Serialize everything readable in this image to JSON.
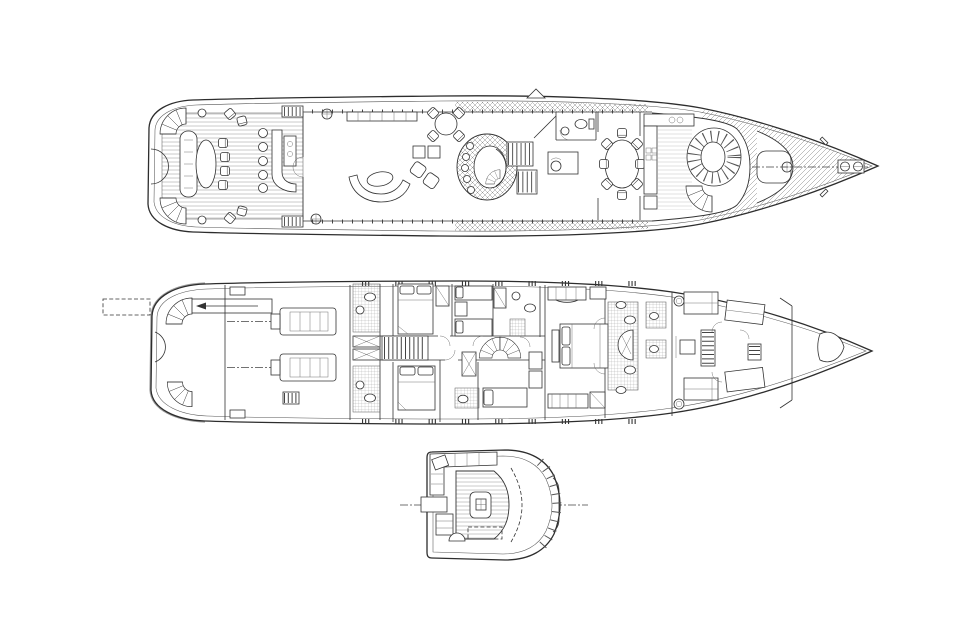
{
  "page": {
    "title": "Yacht general arrangement plans",
    "background_color": "#ffffff",
    "line_color": "#2d2d2d",
    "hull_shadow_color": "#9a9a9a"
  },
  "views": [
    {
      "id": "main-deck-plan",
      "features": [
        "aft-fan-stairs",
        "transom-bench",
        "cocktail-table",
        "deck-chairs",
        "wet-bar",
        "bar-stools",
        "salon-sofa",
        "armchairs",
        "crescent-sofa",
        "coffee-table",
        "card-table",
        "atrium-skylight",
        "spiral-stair",
        "companionway-stairs",
        "study-desk",
        "day-head",
        "dining-table",
        "dining-chairs",
        "galley-counters",
        "breakfast-booth",
        "foredeck-seat",
        "capstan",
        "anchor-windlass",
        "bow-cleats",
        "mast"
      ]
    },
    {
      "id": "lower-deck-plan",
      "features": [
        "passerelle",
        "passerelle-garage",
        "transom-fan-stairs",
        "engine-room",
        "port-engine",
        "starboard-engine",
        "engine-room-ladder",
        "guest-head-port",
        "guest-head-starboard",
        "guest-cabin-double-aft",
        "guest-cabin-twin",
        "guest-cabin-double-fwd",
        "corridor-stairs",
        "spiral-stair",
        "single-berth",
        "master-stateroom",
        "master-bed",
        "master-sofa",
        "master-bath",
        "round-shower",
        "crew-bunks",
        "crew-mess",
        "crew-stairs",
        "laundry-machines",
        "forepeak"
      ]
    },
    {
      "id": "wheelhouse-plan",
      "features": [
        "helm-console",
        "helm-chair",
        "l-settee",
        "corner-table",
        "windshield-mullions",
        "dashboard",
        "equipment-cabinet",
        "centerline"
      ]
    }
  ]
}
